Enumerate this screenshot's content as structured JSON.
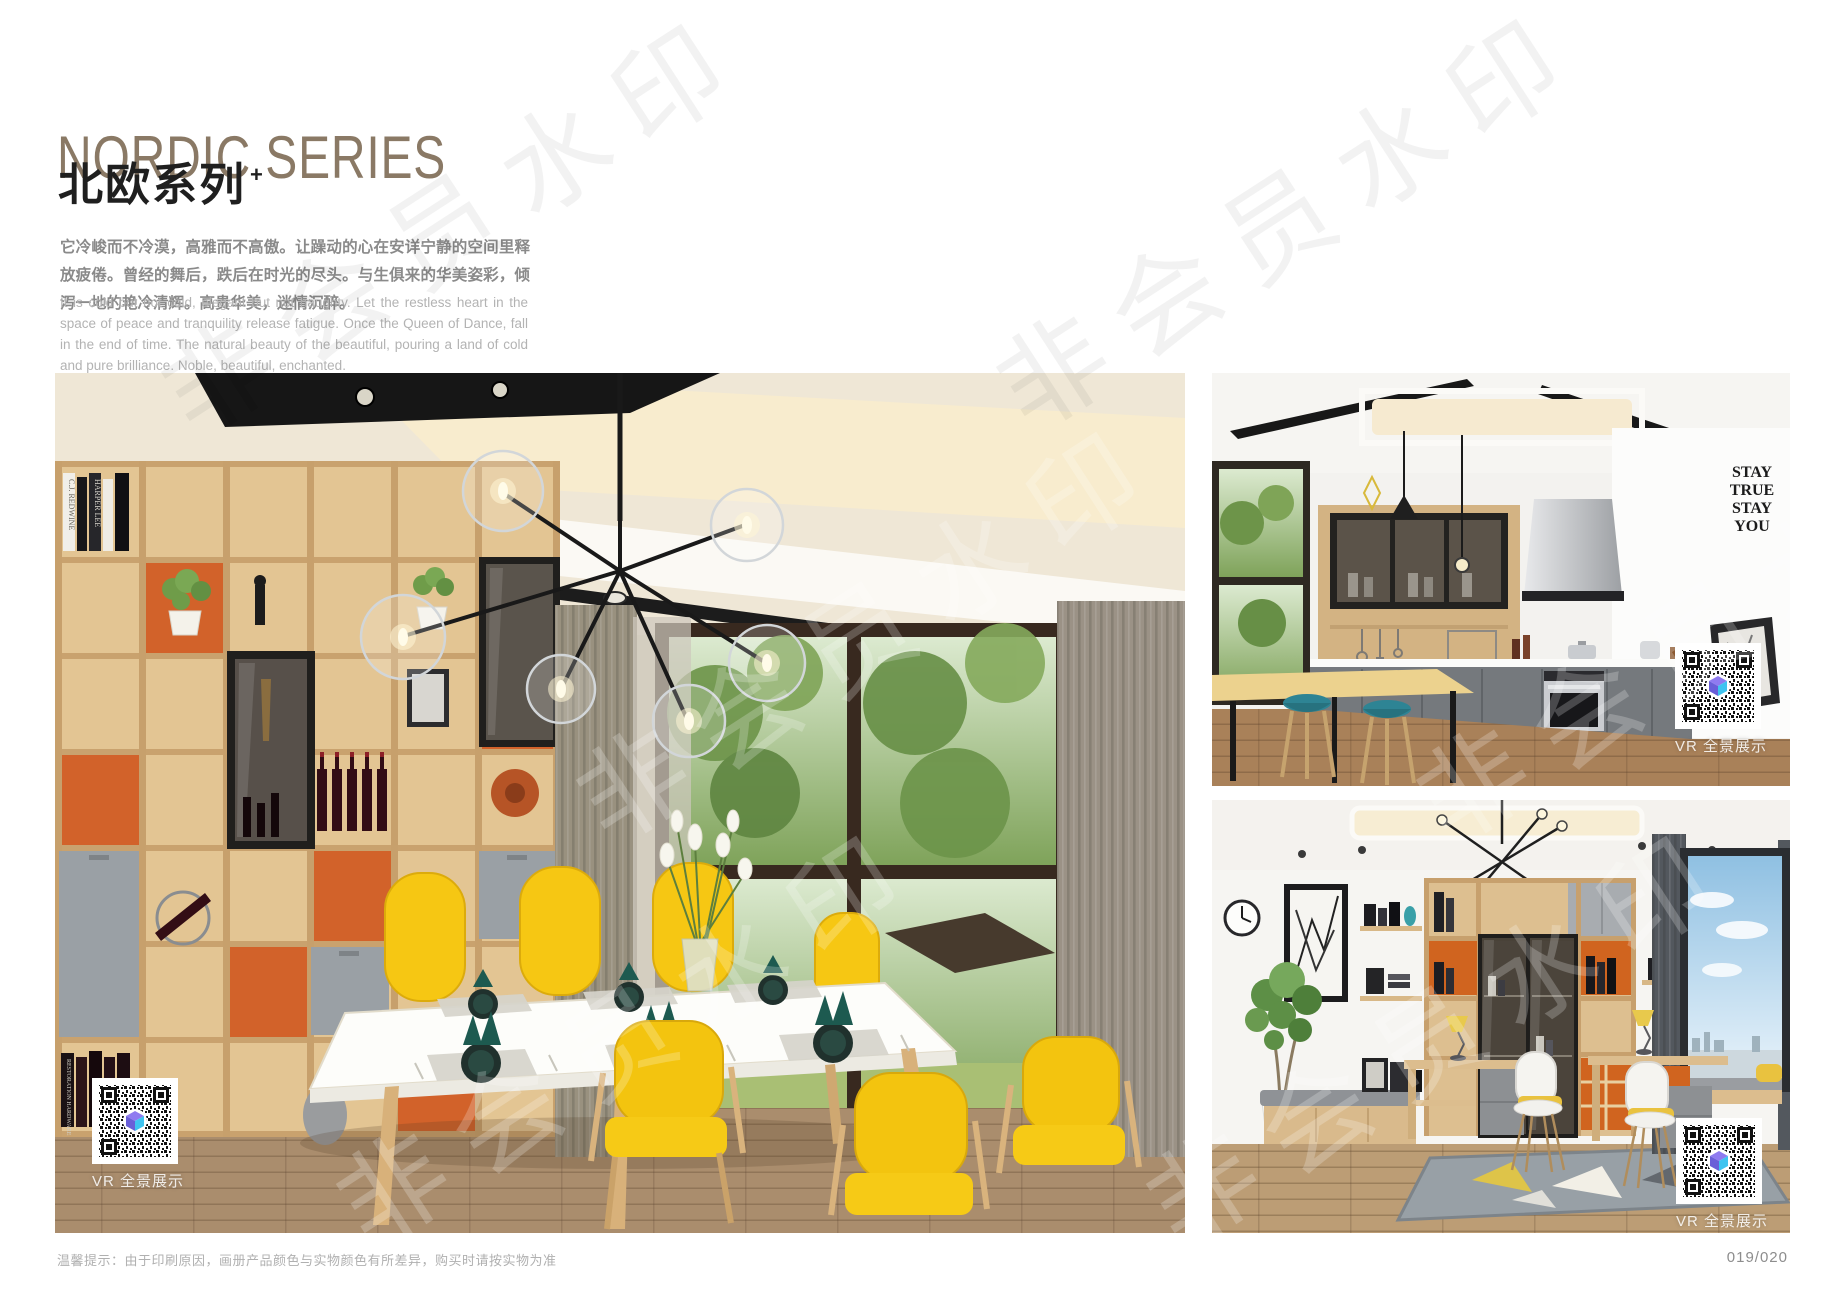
{
  "header": {
    "title_en": "NORDIC SERIES",
    "title_cn": "北欧系列",
    "title_sup": "+",
    "intro_cn": "它冷峻而不冷漠，高雅而不高傲。让躁动的心在安详宁静的空间里释放疲倦。曾经的舞后，跌后在时光的尽头。与生俱来的华美姿彩，倾泻一地的艳冷清辉。高贵华美，迷情沉醉。",
    "intro_en": "It is cold but not cold, elegant but not haughty. Let the restless heart in the space of peace and tranquility release fatigue. Once the Queen of Dance, fall in the end of time. The natural beauty of the beautiful, pouring a land of cold and pure brilliance. Noble, beautiful, enchanted."
  },
  "photos": {
    "dining": {
      "caption": "VR 全景展示",
      "book_spines": [
        "C.J. REDWINE",
        "HARPER LEE",
        "RESTORATION HARDWARE"
      ]
    },
    "kitchen": {
      "caption": "VR 全景展示",
      "wall_art": [
        "STAY",
        "TRUE",
        "STAY",
        "YOU"
      ]
    },
    "study": {
      "caption": "VR 全景展示"
    }
  },
  "footer": {
    "note": "温馨提示：由于印刷原因，画册产品颜色与实物颜色有所差异，购买时请按实物为准",
    "page_number": "019/020"
  },
  "watermark": {
    "text": "非会员水印"
  },
  "colors": {
    "title_taupe": "#8A7965",
    "cabinet_orange": "#D2622A",
    "chair_yellow": "#F6C713",
    "stool_teal": "#2E8494",
    "napkin_teal": "#1D5A50",
    "qr_logo_purple": "#8F7BF0",
    "qr_logo_blue": "#3FC4F0"
  }
}
